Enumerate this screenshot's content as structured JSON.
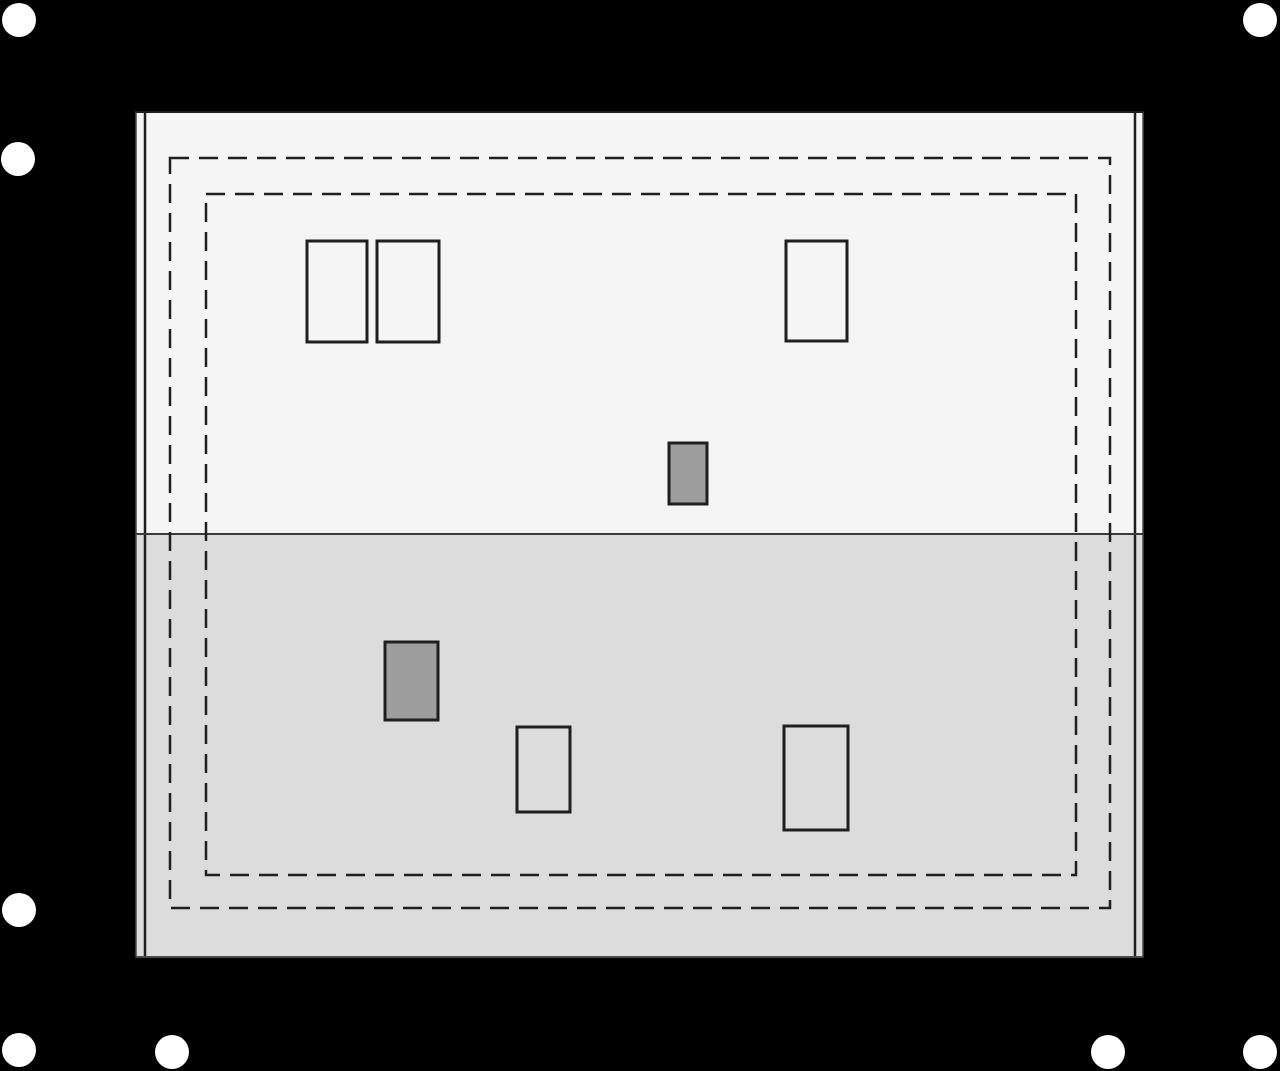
{
  "title": "roof-plan-diagram",
  "canvas": {
    "width": 1280,
    "height": 1071,
    "background": "#000000"
  },
  "colors": {
    "upper_roof_fill": "#f5f5f5",
    "lower_roof_fill": "#dcdcdc",
    "outline": "#1f1f1f",
    "thin_edge_line": "#4a4a4a",
    "ridge_divider": "#3a3a3a",
    "dashed_line": "#1f1f1f",
    "chimney_fill": "#9e9e9e",
    "marker_fill": "#ffffff"
  },
  "roof": {
    "outer": {
      "x": 136,
      "y": 112,
      "w": 1007,
      "h": 845
    },
    "inner_left_x": 145,
    "inner_right_x": 1135,
    "ridge_y": 534
  },
  "dash_pattern": "19 10",
  "stroke_widths": {
    "outer_edge": 1.5,
    "inner_edge": 2.5,
    "ridge": 2,
    "dashed": 2.5,
    "opening": 3
  },
  "dashed_rects": [
    {
      "name": "eaves-outline-outer",
      "x": 170,
      "y": 158,
      "w": 940,
      "h": 750
    },
    {
      "name": "eaves-outline-inner",
      "x": 206,
      "y": 194,
      "w": 870,
      "h": 681
    }
  ],
  "openings": [
    {
      "name": "roof-window-1",
      "x": 307,
      "y": 241,
      "w": 60,
      "h": 101,
      "filled": false
    },
    {
      "name": "roof-window-2",
      "x": 377,
      "y": 241,
      "w": 62,
      "h": 101,
      "filled": false
    },
    {
      "name": "roof-window-3",
      "x": 786,
      "y": 241,
      "w": 61,
      "h": 100,
      "filled": false
    },
    {
      "name": "chimney-1",
      "x": 669,
      "y": 443,
      "w": 38,
      "h": 61,
      "filled": true
    },
    {
      "name": "chimney-2",
      "x": 385,
      "y": 642,
      "w": 53,
      "h": 78,
      "filled": true
    },
    {
      "name": "roof-window-4",
      "x": 517,
      "y": 727,
      "w": 53,
      "h": 85,
      "filled": false
    },
    {
      "name": "roof-window-5",
      "x": 784,
      "y": 726,
      "w": 64,
      "h": 104,
      "filled": false
    }
  ],
  "markers": [
    {
      "name": "marker-dot-1",
      "cx": 19,
      "cy": 20,
      "r": 17
    },
    {
      "name": "marker-dot-2",
      "cx": 1260,
      "cy": 20,
      "r": 17
    },
    {
      "name": "marker-dot-3",
      "cx": 18,
      "cy": 159,
      "r": 17
    },
    {
      "name": "marker-dot-4",
      "cx": 19,
      "cy": 910,
      "r": 17
    },
    {
      "name": "marker-dot-5",
      "cx": 19,
      "cy": 1050,
      "r": 17
    },
    {
      "name": "marker-dot-6",
      "cx": 172,
      "cy": 1052,
      "r": 17
    },
    {
      "name": "marker-dot-7",
      "cx": 1108,
      "cy": 1052,
      "r": 17
    },
    {
      "name": "marker-dot-8",
      "cx": 1260,
      "cy": 1052,
      "r": 17
    }
  ]
}
